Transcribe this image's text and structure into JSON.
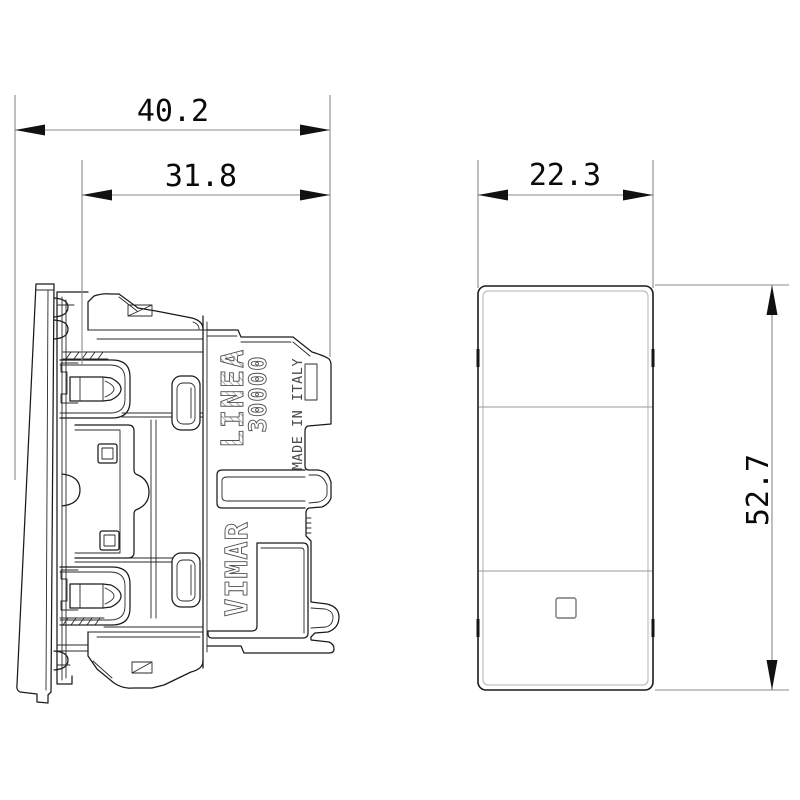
{
  "side_view": {
    "markings": {
      "series": "LINEA",
      "model": "30000",
      "origin": "MADE IN ITALY",
      "brand": "VIMAR"
    }
  },
  "dimensions": {
    "overall_depth": "40.2",
    "mechanism_depth": "31.8",
    "front_width": "22.3",
    "front_height": "52.7"
  },
  "colors": {
    "background": "#ffffff",
    "drawing_line": "#1a1a1a",
    "dimension_line": "#8a8a8a",
    "dimension_text": "#0a0a0a",
    "marking_outline": "#4f4f4f"
  }
}
